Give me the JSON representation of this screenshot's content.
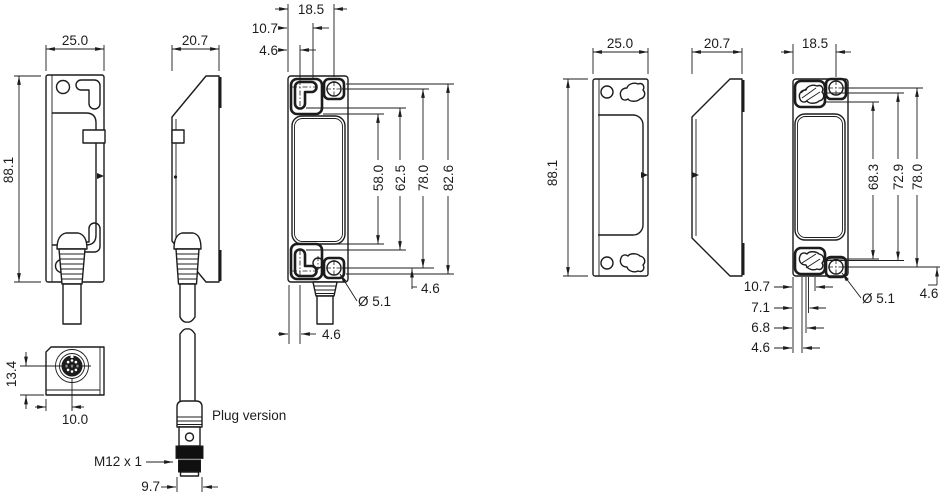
{
  "drawing": {
    "title": "Sensor dimensional drawing, cable and plug versions",
    "colors": {
      "line": "#1c1c1c",
      "plug_fill": "#101010",
      "background": "#ffffff"
    },
    "left": {
      "side": {
        "w": "25.0",
        "h": "88.1"
      },
      "side2": {
        "w": "20.7"
      },
      "front": {
        "w": "18.5",
        "off1": "10.7",
        "off2": "4.6",
        "chain": [
          "58.0",
          "62.5",
          "78.0",
          "82.6"
        ],
        "dia": "Ø 5.1",
        "right_off": "4.6",
        "bottom_off": "4.6"
      },
      "bottom": {
        "h": "13.4",
        "w": "10.0"
      },
      "plug": {
        "caption": "Plug version",
        "thread": "M12 x 1",
        "w": "9.7"
      }
    },
    "right": {
      "side": {
        "w": "25.0",
        "h": "88.1"
      },
      "side2": {
        "w": "20.7"
      },
      "front": {
        "w": "18.5",
        "chain": [
          "68.3",
          "72.9",
          "78.0"
        ],
        "dia": "Ø 5.1",
        "right_off": "4.6",
        "bottom_chain": [
          "10.7",
          "7.1",
          "6.8",
          "4.6"
        ]
      }
    }
  }
}
